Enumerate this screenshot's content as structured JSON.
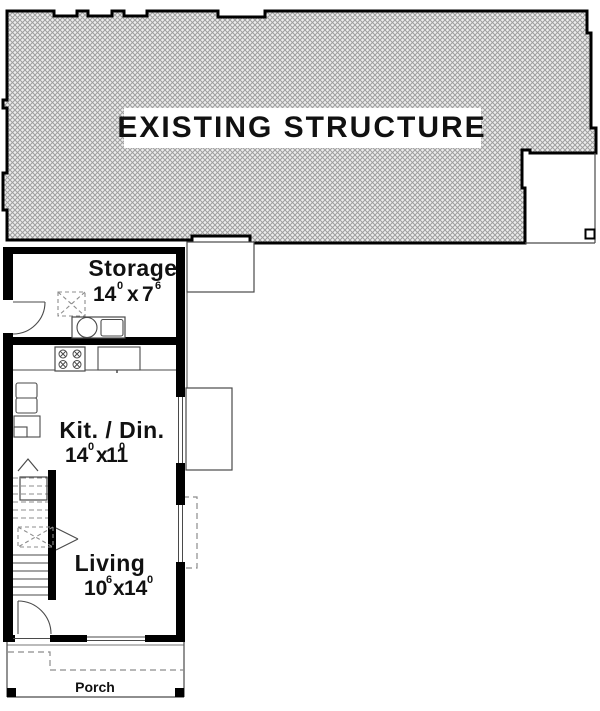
{
  "drawing": {
    "existing_label": "EXISTING STRUCTURE",
    "porch_label": "Porch",
    "rooms": {
      "storage": {
        "name": "Storage",
        "ft1": "14",
        "in1": "0",
        "sep": "x",
        "ft2": "7",
        "in2": "6"
      },
      "kitdin": {
        "name": "Kit. / Din.",
        "ft1": "14",
        "in1": "0",
        "sep": "x",
        "ft2": "11",
        "in2": "0"
      },
      "living": {
        "name": "Living",
        "ft1": "10",
        "in1": "6",
        "sep": "x",
        "ft2": "14",
        "in2": "0"
      }
    },
    "colors": {
      "walls": "#000000",
      "hatch_lines": "#9e9e9e",
      "hatch_bg": "#ededed",
      "paper": "#ffffff",
      "thin_lines": "#4a4a4a",
      "dashed_lines": "#8c8c8c"
    }
  }
}
